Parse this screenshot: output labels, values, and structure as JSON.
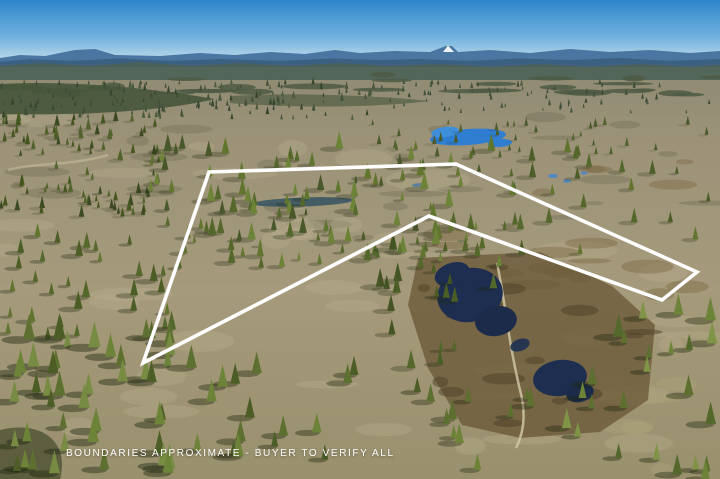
{
  "image": {
    "width": 720,
    "height": 479,
    "description": "aerial drone photo of rural acreage with property boundary overlay"
  },
  "overlay": {
    "disclaimer": "BOUNDARIES APPROXIMATE - BUYER TO VERIFY ALL",
    "text_color": "#ffffff"
  },
  "boundary": {
    "points_str": "209,172 456,164 697,272 662,300 429,216 143,363",
    "stroke_color": "#ffffff",
    "stroke_width": 3.6
  },
  "palette": {
    "sky_top": "#2f86cb",
    "sky_mid": "#6fb0dd",
    "sky_horizon": "#cfe2ec",
    "mountain": "#44719d",
    "mountain_near": "#3c5f80",
    "snow_peak": "#eef3f7",
    "far_forest": "#4b6258",
    "field_light": "#a59a7b",
    "field_dark": "#8d8973",
    "pond_bright": "#2f7ed2",
    "pond_dark": "#1d2e50",
    "marsh": "#6a5939",
    "pine_light": "#6d8338",
    "pine_dark": "#46561f",
    "trail": "#cfc5a3"
  },
  "scene": {
    "sky": {
      "stops": [
        [
          "0",
          "#2f86cb"
        ],
        [
          "0.55",
          "#6fb0dd"
        ],
        [
          "1",
          "#cfe2ec"
        ]
      ],
      "h": 66
    },
    "field": {
      "y": 60,
      "stops": [
        [
          "0",
          "#8d8973"
        ],
        [
          "0.18",
          "#9b9278"
        ],
        [
          "0.55",
          "#a59a7b"
        ],
        [
          "1",
          "#99906e"
        ]
      ]
    },
    "ridges": [
      {
        "d": "M0,58 L20,55 L45,56 L75,50 L95,49 L115,55 L160,56 L200,53 L235,55 L270,52 L305,54 L335,50 L360,53 L395,51 L430,52 L446,46 L452,46 L458,52 L490,50 L530,53 L570,49 L610,52 L650,50 L690,53 L720,51 L720,64 L0,64 Z",
        "fill": "#44719d",
        "opacity": 0.95
      },
      {
        "d": "M443,52 448,45.5 454,52 Z",
        "fill": "#eef3f7",
        "opacity": 1
      },
      {
        "d": "M0,62 L30,59 L70,61 L120,58.5 L170,61 L220,59 L280,61 L330,58.5 L380,60 L420,59 L470,61 L520,58.5 L570,60 L620,58 L670,61 L720,59 L720,67 L0,67 Z",
        "fill": "#3c5f80",
        "opacity": 0.95
      },
      {
        "d": "M0,66 L40,63 L90,66 L140,62 L190,66 L240,63 L290,66 L340,63 L390,66 L440,64 L490,67 L540,64 L590,67 L640,64 L690,67 L720,65 L720,80 L0,80 Z",
        "fill": "#4b6258",
        "opacity": 0.9
      }
    ],
    "dark_areas": [
      {
        "d": "M0,84 C70,80 150,88 215,99 C170,110 90,116 0,114 Z",
        "fill": "#47553b",
        "opacity": 0.9
      },
      {
        "d": "M230,96 C300,92 380,96 430,101 C370,108 290,108 230,103 Z",
        "fill": "#515e42",
        "opacity": 0.7
      },
      {
        "d": "M0,430 C40,420 70,440 60,479 L0,479 Z",
        "fill": "#2c3517",
        "opacity": 0.55
      }
    ],
    "blob_sets": [
      {
        "seed": 36,
        "count": 30,
        "x": 0,
        "y": 74,
        "w": 720,
        "h": 22,
        "rx": [
          10,
          34
        ],
        "ry": [
          1.5,
          3.2
        ],
        "fill": "#4d5b44",
        "opacity": 0.85
      },
      {
        "seed": 32,
        "count": 26,
        "x": 0,
        "y": 88,
        "w": 720,
        "h": 150,
        "rx": [
          8,
          36
        ],
        "ry": [
          2,
          6
        ],
        "fill": "#6e6a52",
        "opacity": 0.35
      },
      {
        "seed": 31,
        "count": 42,
        "x": 0,
        "y": 112,
        "w": 720,
        "h": 340,
        "rx": [
          12,
          46
        ],
        "ry": [
          3,
          11
        ],
        "fill": "#bcb292",
        "opacity": 0.3
      },
      {
        "seed": 33,
        "count": 18,
        "x": 430,
        "y": 150,
        "w": 290,
        "h": 150,
        "rx": [
          8,
          30
        ],
        "ry": [
          2.5,
          7
        ],
        "fill": "#77633f",
        "opacity": 0.4
      },
      {
        "seed": 37,
        "count": 10,
        "x": 600,
        "y": 300,
        "w": 120,
        "h": 170,
        "rx": [
          10,
          28
        ],
        "ry": [
          3,
          8
        ],
        "fill": "#a8a178",
        "opacity": 0.5
      }
    ],
    "marsh": {
      "d": "M418,258 L540,252 L612,286 L655,325 L648,400 L600,432 L520,438 L462,425 L428,368 L408,305 Z",
      "fill": "#6a5939",
      "opacity": 0.78
    },
    "marsh_texture": {
      "seed": 34,
      "count": 16,
      "x": 420,
      "y": 265,
      "w": 230,
      "h": 165,
      "rx": [
        6,
        22
      ],
      "ry": [
        2,
        6
      ],
      "fill": "#4e3f27",
      "opacity": 0.5
    },
    "trails": [
      {
        "d": "M497,263 C505,300 508,340 520,390 C526,412 524,432 516,448",
        "stroke": "#cfc5a3",
        "w": 2.5,
        "opacity": 0.85
      },
      {
        "d": "M8,170 C40,162 70,166 108,155",
        "stroke": "#c4bb9b",
        "w": 2.5,
        "opacity": 0.6
      }
    ],
    "ponds_bright": [
      {
        "cx": 468,
        "cy": 137,
        "rx": 38,
        "ry": 8,
        "rot": -4,
        "fill": "#2f7ed2",
        "opacity": 1
      },
      {
        "cx": 445,
        "cy": 132,
        "rx": 14,
        "ry": 5,
        "rot": -8,
        "fill": "#3f8eda",
        "opacity": 1
      },
      {
        "cx": 500,
        "cy": 143,
        "rx": 12,
        "ry": 4,
        "rot": -4,
        "fill": "#2f7ed2",
        "opacity": 1
      },
      {
        "cx": 553,
        "cy": 176,
        "rx": 5,
        "ry": 2,
        "rot": 0,
        "fill": "#4a85c8",
        "opacity": 0.9
      },
      {
        "cx": 567,
        "cy": 181,
        "rx": 4,
        "ry": 1.8,
        "rot": 0,
        "fill": "#4a85c8",
        "opacity": 0.9
      },
      {
        "cx": 584,
        "cy": 173,
        "rx": 3.5,
        "ry": 1.6,
        "rot": 0,
        "fill": "#4a85c8",
        "opacity": 0.85
      },
      {
        "cx": 418,
        "cy": 185,
        "rx": 6,
        "ry": 1.8,
        "rot": -3,
        "fill": "#49799e",
        "opacity": 0.8
      },
      {
        "cx": 303,
        "cy": 202,
        "rx": 50,
        "ry": 4.5,
        "rot": -2,
        "fill": "#3a5560",
        "opacity": 0.9
      }
    ],
    "ponds_dark": [
      {
        "cx": 470,
        "cy": 295,
        "rx": 33,
        "ry": 27,
        "rot": -12,
        "fill": "#1d2e50",
        "opacity": 1
      },
      {
        "cx": 452,
        "cy": 274,
        "rx": 18,
        "ry": 11,
        "rot": -20,
        "fill": "#1d2e50",
        "opacity": 1
      },
      {
        "cx": 496,
        "cy": 321,
        "rx": 21,
        "ry": 15,
        "rot": -10,
        "fill": "#1c2b4a",
        "opacity": 1
      },
      {
        "cx": 520,
        "cy": 345,
        "rx": 10,
        "ry": 6,
        "rot": -20,
        "fill": "#223351",
        "opacity": 0.95
      },
      {
        "cx": 560,
        "cy": 378,
        "rx": 27,
        "ry": 18,
        "rot": -8,
        "fill": "#1d2e50",
        "opacity": 1
      },
      {
        "cx": 580,
        "cy": 393,
        "rx": 14,
        "ry": 9,
        "rot": -14,
        "fill": "#1c2b4a",
        "opacity": 1
      }
    ],
    "tree_regions": [
      {
        "seed": 11,
        "x": 0,
        "y": 84,
        "w": 380,
        "h": 36,
        "count": 170,
        "smin": 1.6,
        "smax": 3.4,
        "palette": [
          "#41503a",
          "#4a5a3c",
          "#37462f"
        ],
        "shadow": 0
      },
      {
        "seed": 12,
        "x": 380,
        "y": 84,
        "w": 340,
        "h": 30,
        "count": 70,
        "smin": 1.4,
        "smax": 2.8,
        "palette": [
          "#465741",
          "#3d4c35"
        ],
        "shadow": 0
      },
      {
        "seed": 13,
        "x": 0,
        "y": 118,
        "w": 160,
        "h": 100,
        "count": 90,
        "smin": 2.5,
        "smax": 5,
        "palette": [
          "#46561f",
          "#52642c",
          "#3c4a22"
        ],
        "shadow": 0.2
      },
      {
        "seed": 21,
        "x": 360,
        "y": 124,
        "w": 360,
        "h": 36,
        "count": 36,
        "smin": 2,
        "smax": 4.2,
        "palette": [
          "#4a5a2b",
          "#53642f"
        ],
        "shadow": 0.15
      },
      {
        "seed": 14,
        "x": 150,
        "y": 148,
        "w": 350,
        "h": 120,
        "count": 120,
        "smin": 3,
        "smax": 7.5,
        "palette": [
          "#55682c",
          "#61752f",
          "#6d8338",
          "#49582a"
        ],
        "shadow": 0.35
      },
      {
        "seed": 15,
        "x": 500,
        "y": 150,
        "w": 220,
        "h": 110,
        "count": 26,
        "smin": 3,
        "smax": 6.5,
        "palette": [
          "#55682c",
          "#61752f",
          "#4d5d28"
        ],
        "shadow": 0.3
      },
      {
        "seed": 20,
        "x": 0,
        "y": 236,
        "w": 185,
        "h": 104,
        "count": 34,
        "smin": 4,
        "smax": 8,
        "palette": [
          "#55682c",
          "#61752f",
          "#4c5d26"
        ],
        "shadow": 0.4
      },
      {
        "seed": 19,
        "x": 380,
        "y": 248,
        "w": 115,
        "h": 125,
        "count": 20,
        "smin": 4,
        "smax": 8,
        "palette": [
          "#4c5d26",
          "#55682c",
          "#445424"
        ],
        "shadow": 0.35
      },
      {
        "seed": 18,
        "x": 560,
        "y": 300,
        "w": 160,
        "h": 179,
        "count": 24,
        "smin": 5,
        "smax": 10,
        "palette": [
          "#5d7030",
          "#55682c",
          "#6d8338",
          "#7f9446"
        ],
        "shadow": 0.5
      },
      {
        "seed": 22,
        "x": 430,
        "y": 398,
        "w": 130,
        "h": 80,
        "count": 10,
        "smin": 5,
        "smax": 9,
        "palette": [
          "#5d7030",
          "#6d8338"
        ],
        "shadow": 0.45
      },
      {
        "seed": 17,
        "x": 175,
        "y": 360,
        "w": 255,
        "h": 119,
        "count": 17,
        "smin": 6,
        "smax": 10,
        "palette": [
          "#5d7030",
          "#6d8338",
          "#4c5d26"
        ],
        "shadow": 0.5
      },
      {
        "seed": 16,
        "x": 0,
        "y": 336,
        "w": 175,
        "h": 143,
        "count": 42,
        "smin": 6,
        "smax": 11,
        "palette": [
          "#5d7030",
          "#6d8338",
          "#4c5d26",
          "#778c42"
        ],
        "shadow": 0.55
      }
    ]
  }
}
